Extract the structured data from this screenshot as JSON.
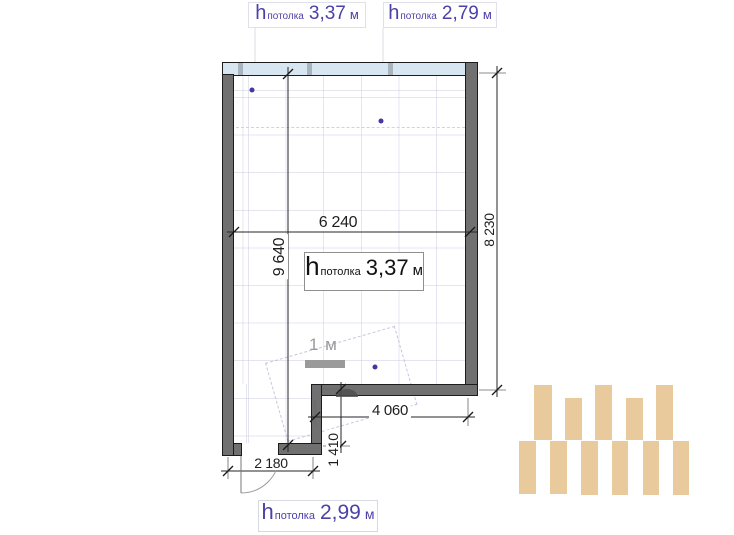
{
  "drawing": {
    "type": "floor-plan",
    "language": "ru"
  },
  "colors": {
    "accent_purple": "#4d41a8",
    "dot_purple": "#4338a2",
    "wall_gray": "#707070",
    "glazing_blue": "#d8e6f2",
    "logo_beige": "#e9ca9d",
    "dim_text": "#1e1e1e",
    "scale_gray": "#9a9a9a"
  },
  "ceiling_labels": {
    "top_left": {
      "h": "h",
      "sub": "потолка",
      "value": "3,37",
      "unit": "м"
    },
    "top_right": {
      "h": "h",
      "sub": "потолка",
      "value": "2,79",
      "unit": "м"
    },
    "room_center": {
      "h": "h",
      "sub": "потолка",
      "value": "3,37",
      "unit": "м"
    },
    "bottom": {
      "h": "h",
      "sub": "потолка",
      "value": "2,99",
      "unit": "м"
    }
  },
  "dimensions_mm": {
    "room_width": "6 240",
    "room_height_left": "9 640",
    "room_height_right": "8 230",
    "step_width": "4 060",
    "step_height": "1 410",
    "door_wall_width": "2 180"
  },
  "scale_bar": {
    "label": "1 м"
  },
  "dots": [
    {
      "x": 252,
      "y": 90
    },
    {
      "x": 381,
      "y": 121
    },
    {
      "x": 375,
      "y": 367
    }
  ],
  "logo": {
    "color": "#e9ca9d",
    "bars": [
      {
        "x": 534,
        "y": 385,
        "w": 18,
        "h": 55
      },
      {
        "x": 565,
        "y": 398,
        "w": 17,
        "h": 42
      },
      {
        "x": 595,
        "y": 385,
        "w": 17,
        "h": 55
      },
      {
        "x": 626,
        "y": 398,
        "w": 17,
        "h": 42
      },
      {
        "x": 656,
        "y": 385,
        "w": 17,
        "h": 55
      },
      {
        "x": 519,
        "y": 441,
        "w": 17,
        "h": 53
      },
      {
        "x": 550,
        "y": 441,
        "w": 17,
        "h": 53
      },
      {
        "x": 581,
        "y": 441,
        "w": 17,
        "h": 54
      },
      {
        "x": 612,
        "y": 441,
        "w": 16,
        "h": 54
      },
      {
        "x": 643,
        "y": 441,
        "w": 16,
        "h": 54
      },
      {
        "x": 673,
        "y": 441,
        "w": 16,
        "h": 54
      }
    ]
  }
}
